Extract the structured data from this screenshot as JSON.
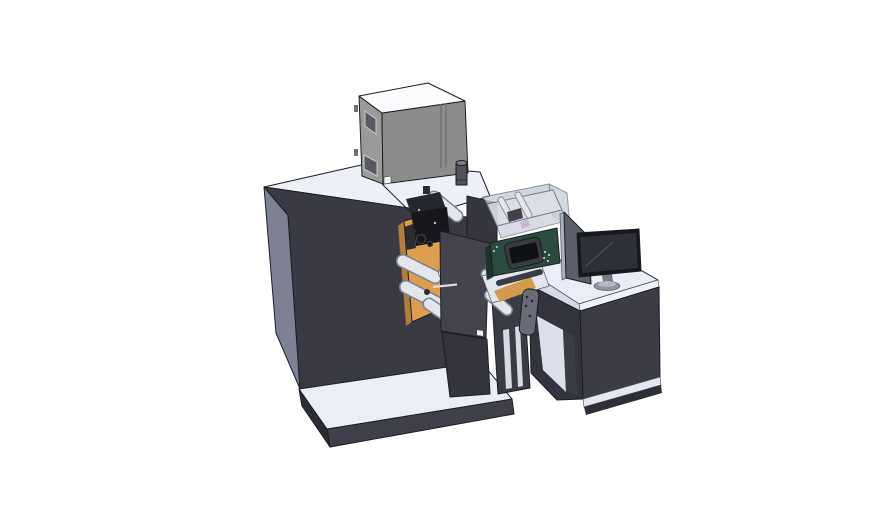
{
  "scene": {
    "kind": "3d-cad-render",
    "parts": [
      "main press cabinet",
      "electrical cabinet",
      "exhaust pipe",
      "print head unit",
      "unwind rollers",
      "web guide plate",
      "transparent safety enclosure",
      "hmi control panel",
      "outfeed table",
      "junction box",
      "machine base platform",
      "operator desk",
      "desk divider panel",
      "computer monitor"
    ]
  },
  "colors": {
    "background": "#ffffff",
    "machine_top": "#edf0f7",
    "machine_side_left": "#7d8193",
    "machine_front": "#3a3a45",
    "machine_slab": "#35363f",
    "seam": "#23242b",
    "cabinet_top": "#fbfcfd",
    "cabinet_left": "#9a9b98",
    "cabinet_front": "#8c8d8b",
    "cabinet_window": "#585a61",
    "cabinet_slot": "#6f7173",
    "cabinet_foot": "#f2f3f5",
    "exhaust_body": "#515359",
    "exhaust_top": "#7b7d84",
    "exhaust_ring": "#2f3035",
    "enclosure_wall": "#c6cbd6",
    "enclosure_floor": "#d8dce6",
    "enclosure_dark": "#33343b",
    "magenta_part": "#c75fc9",
    "roller_outline": "#7e828d",
    "roller_body": "#e3e6ec",
    "roller_cap": "#2b2c31",
    "orange_panel": "#dc9f4e",
    "orange_panel_dark": "#b57f35",
    "orange_strip": "#d49a4c",
    "head_dark": "#17181d",
    "head_mid": "#26272e",
    "head_arm": "#2b2c33",
    "head_dot": "#c0c3ca",
    "plate_front": "#43434d",
    "plate_label": "#d9dbdf",
    "support_dark": "#34343d",
    "column_dark": "#3b3b45",
    "column_inner": "#d7dbe5",
    "platform_top": "#eaeef6",
    "platform_front": "#3f3f4a",
    "platform_side": "#2c2c35",
    "desk_top": "#eaedf5",
    "desk_edge_light": "#f0f2f8",
    "desk_edge_shade": "#d6dae4",
    "desk_front": "#3c3c46",
    "desk_side": "#34343e",
    "desk_interior": "#dce0ea",
    "desk_plinth": "#e4e8f1",
    "desk_base": "#2e2e37",
    "outfeed_top": "#e2e6ef",
    "outfeed_bar": "#3a3c44",
    "junction_box": "#696c76",
    "junction_dot": "#25262b",
    "divider_face": "#5b5f6c",
    "divider_edge": "#aab0bc",
    "monitor_frame": "#16171b",
    "monitor_screen": "#2e3037",
    "monitor_reflection": "#4d505a",
    "monitor_neck": "#787c88",
    "monitor_base": "#9094a0",
    "monitor_base_top": "#b4b8c2",
    "hmi_green": "#2b4a40",
    "hmi_green_dark": "#1c332b",
    "hmi_bezel": "#3a3b41",
    "hmi_screen": "#101114",
    "hmi_dot": "#c9cdd2"
  }
}
